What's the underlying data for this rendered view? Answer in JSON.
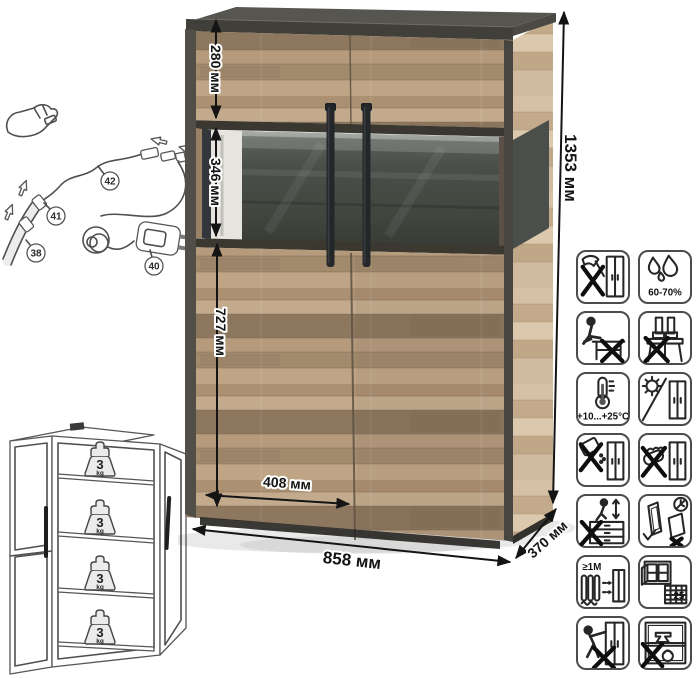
{
  "product": {
    "type": "display-cabinet",
    "colors": {
      "wood_front": "#b29779",
      "wood_side": "#ccb597",
      "frame_dark": "#44433e",
      "glass_back_panel": "#464b45",
      "handle": "#24272a"
    }
  },
  "dimensions": {
    "total_height": "1353 мм",
    "total_width": "858 мм",
    "depth": "370 мм",
    "top_section_height": "280 мм",
    "glass_section_height": "346 мм",
    "lower_section_height": "727 мм",
    "door_width": "408 мм"
  },
  "wiring_diagram": {
    "part_labels": [
      "42",
      "41",
      "38",
      "40"
    ]
  },
  "load_diagram": {
    "weights": [
      {
        "value": "3",
        "unit": "kg"
      },
      {
        "value": "3",
        "unit": "kg"
      },
      {
        "value": "3",
        "unit": "kg"
      },
      {
        "value": "3",
        "unit": "kg"
      }
    ]
  },
  "care_icons": [
    {
      "name": "no-sharp-tools"
    },
    {
      "name": "humidity-range",
      "label": "60-70%"
    },
    {
      "name": "no-sitting"
    },
    {
      "name": "no-standing"
    },
    {
      "name": "temperature-range",
      "label": "+10...+25°C"
    },
    {
      "name": "avoid-direct-sunlight"
    },
    {
      "name": "no-abrasive-cleaners"
    },
    {
      "name": "no-abrasive-sponge"
    },
    {
      "name": "no-climbing-on-drawers"
    },
    {
      "name": "transport-upright"
    },
    {
      "name": "keep-1m-from-heat",
      "label": "≥1M"
    },
    {
      "name": "ventilate-room",
      "label": "25"
    },
    {
      "name": "no-dragging"
    },
    {
      "name": "no-shelf-overload"
    }
  ]
}
